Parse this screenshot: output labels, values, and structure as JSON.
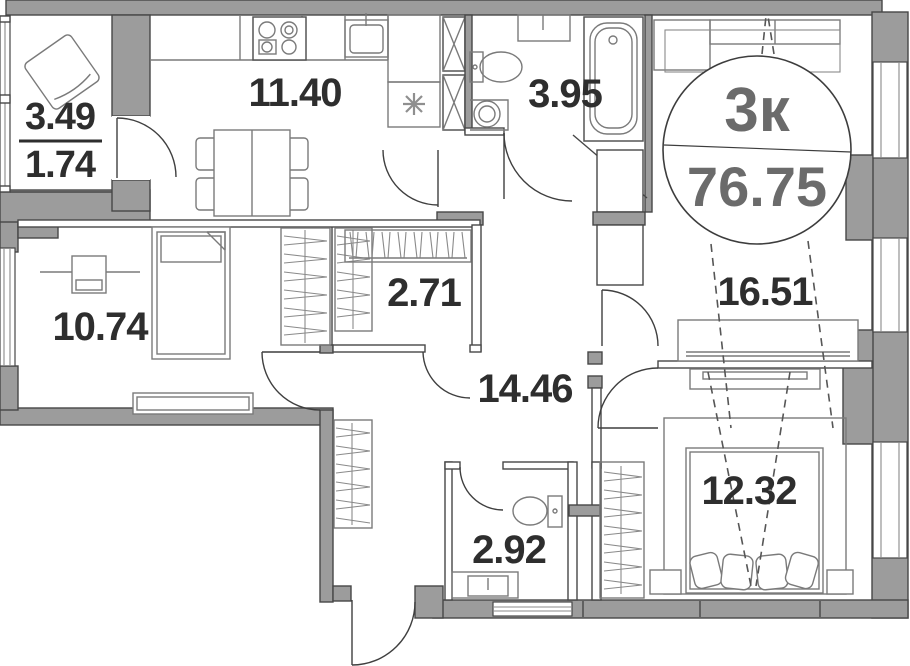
{
  "plan": {
    "badge": {
      "rooms_label": "3к",
      "total_area": "76.75"
    },
    "rooms": {
      "balcony": {
        "area": "3.49",
        "reduced_area": "1.74"
      },
      "kitchen": {
        "area": "11.40"
      },
      "bathroom": {
        "area": "3.95"
      },
      "living_room": {
        "area": "16.51"
      },
      "bedroom_left": {
        "area": "10.74"
      },
      "wardrobe": {
        "area": "2.71"
      },
      "hallway": {
        "area": "14.46"
      },
      "wc": {
        "area": "2.92"
      },
      "bedroom_right": {
        "area": "12.32"
      }
    },
    "icons": [
      "snowflake-marker",
      "stove",
      "kitchen-sink",
      "dining-table",
      "armchair",
      "tall-cabinet",
      "toilet",
      "round-sink",
      "bathtub",
      "vanity-sink",
      "wardrobe-hangers",
      "sofa",
      "tv-console",
      "double-bed",
      "pillows",
      "nightstand",
      "desk",
      "single-bed",
      "dresser"
    ],
    "colors": {
      "wall": "#9c9c9c",
      "outline": "#474747",
      "furniture": "#7a7a7a",
      "label_text": "#2e2e2e",
      "badge_text": "#6b6b6b",
      "dash": "#565656"
    }
  }
}
